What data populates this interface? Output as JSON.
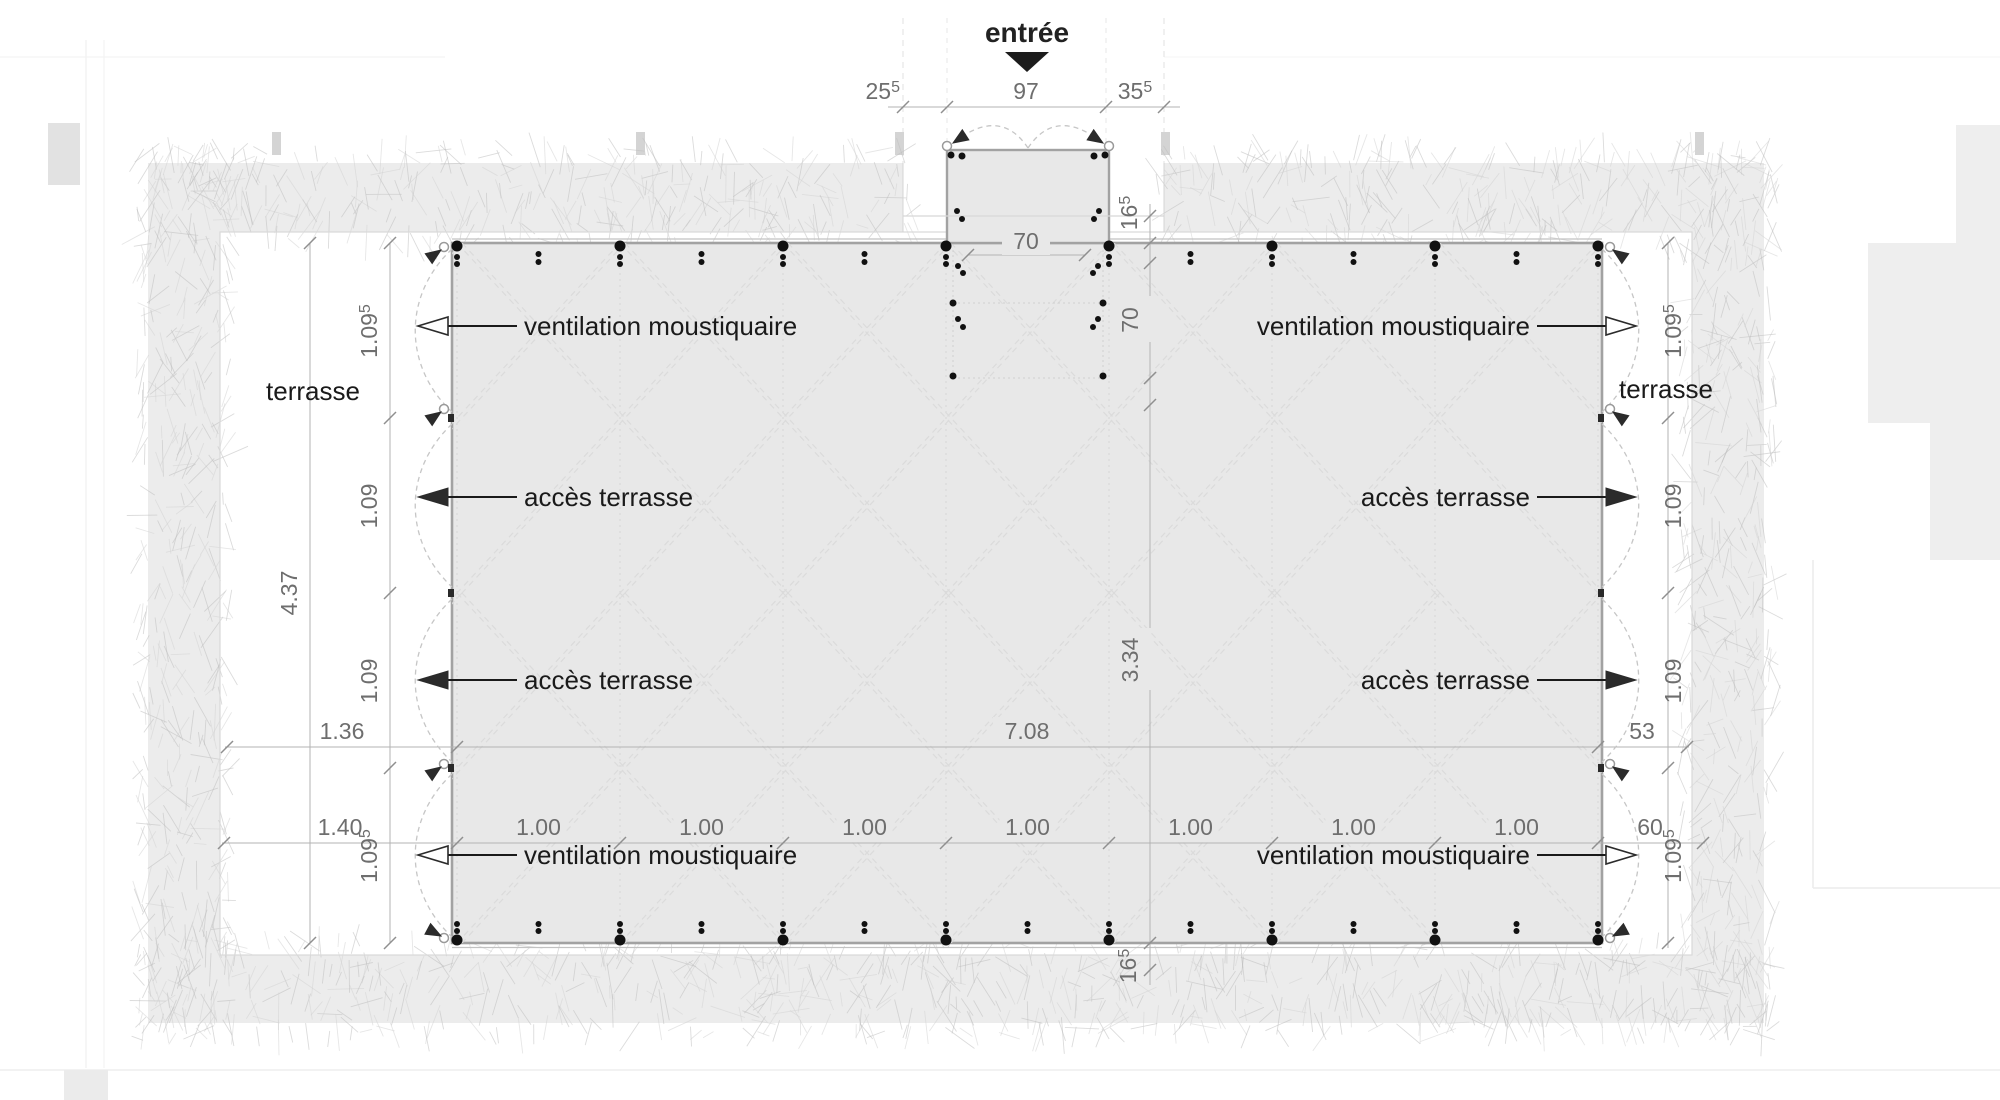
{
  "drawing": {
    "type": "architectural floor plan",
    "entry_label": "entrée"
  },
  "labels": {
    "entree": "entrée",
    "terrasse_left": "terrasse",
    "terrasse_right": "terrasse",
    "ventilation": "ventilation moustiquaire",
    "acces": "accès terrasse"
  },
  "dimensions": {
    "top_chain": [
      {
        "t": "25",
        "s": "5"
      },
      {
        "t": "97"
      },
      {
        "t": "35",
        "s": "5"
      }
    ],
    "entry_width": {
      "t": "70"
    },
    "entry_depth": {
      "t": "70"
    },
    "step_top": {
      "t": "16",
      "s": "5"
    },
    "step_bottom": {
      "t": "16",
      "s": "5"
    },
    "left_outer": {
      "t": "4.37"
    },
    "left_chain": [
      {
        "t": "1.09",
        "s": "5"
      },
      {
        "t": "1.09"
      },
      {
        "t": "1.09"
      },
      {
        "t": "1.09",
        "s": "5"
      }
    ],
    "right_chain": [
      {
        "t": "1.09",
        "s": "5"
      },
      {
        "t": "1.09"
      },
      {
        "t": "1.09"
      },
      {
        "t": "1.09",
        "s": "5"
      }
    ],
    "mid_row": [
      {
        "t": "1.36"
      },
      {
        "t": "7.08"
      },
      {
        "t": "53"
      }
    ],
    "bottom_row_left": {
      "t": "1.40"
    },
    "bottom_row_cells": [
      {
        "t": "1.00"
      },
      {
        "t": "1.00"
      },
      {
        "t": "1.00"
      },
      {
        "t": "1.00"
      },
      {
        "t": "1.00"
      },
      {
        "t": "1.00"
      },
      {
        "t": "1.00"
      }
    ],
    "bottom_row_right": {
      "t": "60"
    },
    "center_vertical": {
      "t": "3.34"
    }
  },
  "callouts": [
    {
      "side": "left",
      "y": 326,
      "label_key": "ventilation",
      "arrow": "open"
    },
    {
      "side": "left",
      "y": 497,
      "label_key": "acces",
      "arrow": "solid"
    },
    {
      "side": "left",
      "y": 680,
      "label_key": "acces",
      "arrow": "solid"
    },
    {
      "side": "left",
      "y": 855,
      "label_key": "ventilation",
      "arrow": "open"
    },
    {
      "side": "right",
      "y": 326,
      "label_key": "ventilation",
      "arrow": "open"
    },
    {
      "side": "right",
      "y": 497,
      "label_key": "acces",
      "arrow": "solid"
    },
    {
      "side": "right",
      "y": 680,
      "label_key": "acces",
      "arrow": "solid"
    },
    {
      "side": "right",
      "y": 855,
      "label_key": "ventilation",
      "arrow": "open"
    }
  ],
  "colors": {
    "floor_fill": "#e8e8e8",
    "wall_stroke": "#a2a2a2",
    "edge_light": "#c2c2c2",
    "grass_fill": "#ececec",
    "grass_stroke_dark": "#bfbfbf",
    "grass_stroke_light": "#d3d3d3",
    "lattice": "#dbdbdb",
    "gridline": "#d6d6d6",
    "dim_line": "#b3b3b3",
    "dim_tick": "#8f8f8f",
    "dim_text": "#6e6e6e",
    "swing_arc": "#c6c6c6",
    "hinge_stroke": "#9a9a9a",
    "post": "#111111",
    "label_text": "#1a1a1a",
    "context": "#eeeeee"
  }
}
